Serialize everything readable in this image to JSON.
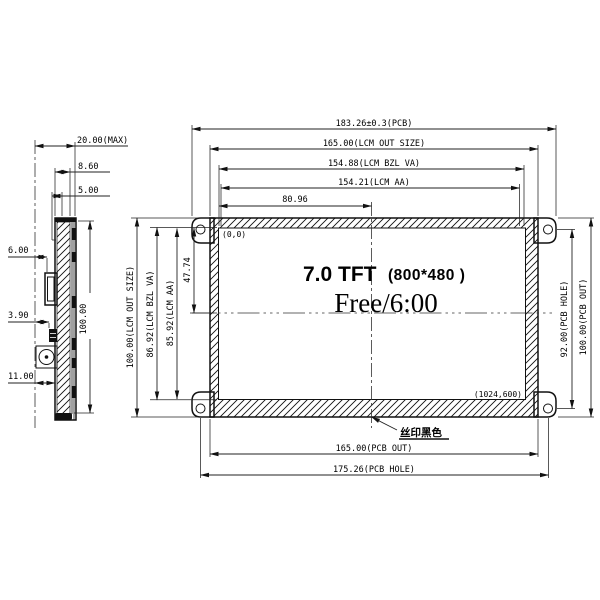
{
  "colors": {
    "ink": "#111111",
    "background": "#ffffff"
  },
  "drawing": {
    "front_view": {
      "top_dims": {
        "pcb_width": "183.26±0.3(PCB)",
        "lcm_out": "165.00(LCM OUT SIZE)",
        "bzl_va": "154.88(LCM BZL VA)",
        "aa": "154.21(LCM AA)",
        "half_aa": "80.96"
      },
      "left_dims": {
        "lcm_out_h": "100.00(LCM OUT SIZE)",
        "bzl_va_h": "86.92(LCM BZL VA)",
        "aa_h": "85.92(LCM AA)",
        "half_h": "47.74"
      },
      "right_dims": {
        "pcb_hole_h": "92.00(PCB HOLE)",
        "pcb_out_h": "100.00(PCB OUT)"
      },
      "bottom_dims": {
        "pcb_out_w": "165.00(PCB OUT)",
        "pcb_hole_w": "175.26(PCB HOLE)"
      },
      "screen": {
        "origin": "(0,0)",
        "corner": "(1024,600)",
        "title": "7.0 TFT",
        "resolution": "(800*480 )",
        "display_text": "Free/6:00"
      },
      "note": "丝印黑色"
    },
    "side_view": {
      "dims": {
        "thickness": "20.00(MAX)",
        "d_8_60": "8.60",
        "d_5_00": "5.00",
        "d_6_00": "6.00",
        "d_3_90": "3.90",
        "d_11_00": "11.00",
        "height": "100.00"
      }
    }
  }
}
